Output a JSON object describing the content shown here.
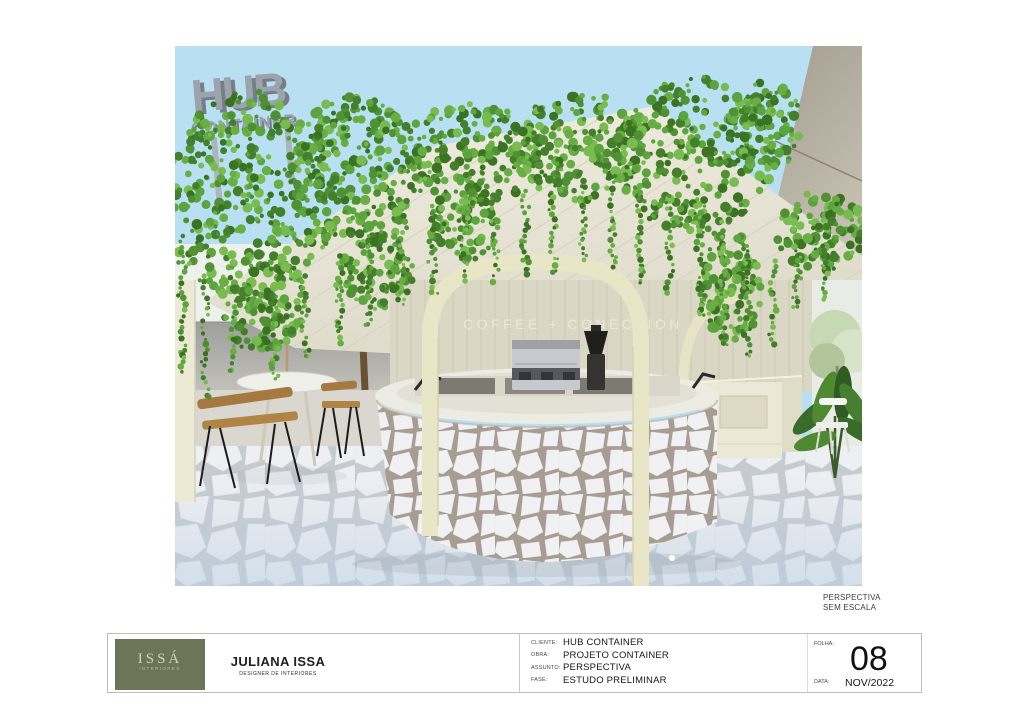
{
  "sheet": {
    "note": {
      "line1": "PERSPECTIVA",
      "line2": "SEM ESCALA"
    }
  },
  "render": {
    "sign": {
      "line1": "HUB",
      "line2": "CONTAINER"
    },
    "wall_text": "COFFEE + CONECTION"
  },
  "title_block": {
    "logo": {
      "name": "ISSÁ",
      "subtitle": "INTERIORES",
      "bg_color": "#6e7457"
    },
    "designer": {
      "name": "JULIANA ISSA",
      "role": "DESIGNER DE INTERIORES"
    },
    "fields": [
      {
        "label": "CLIENTE:",
        "value": "HUB CONTAINER"
      },
      {
        "label": "OBRA:",
        "value": "PROJETO CONTAINER"
      },
      {
        "label": "ASSUNTO:",
        "value": "PERSPECTIVA"
      },
      {
        "label": "FASE:",
        "value": "ESTUDO PRELIMINAR"
      }
    ],
    "sheet_number": {
      "label": "FOLHA:",
      "value": "08"
    },
    "date": {
      "label": "DATA:",
      "value": "NOV/2022"
    }
  },
  "colors": {
    "sky": "#b9e0f2",
    "foliage": "#4c8f2f",
    "cream_structure": "#e9e6c8",
    "canopy": "#aba69a",
    "logo_bg": "#6e7457"
  }
}
